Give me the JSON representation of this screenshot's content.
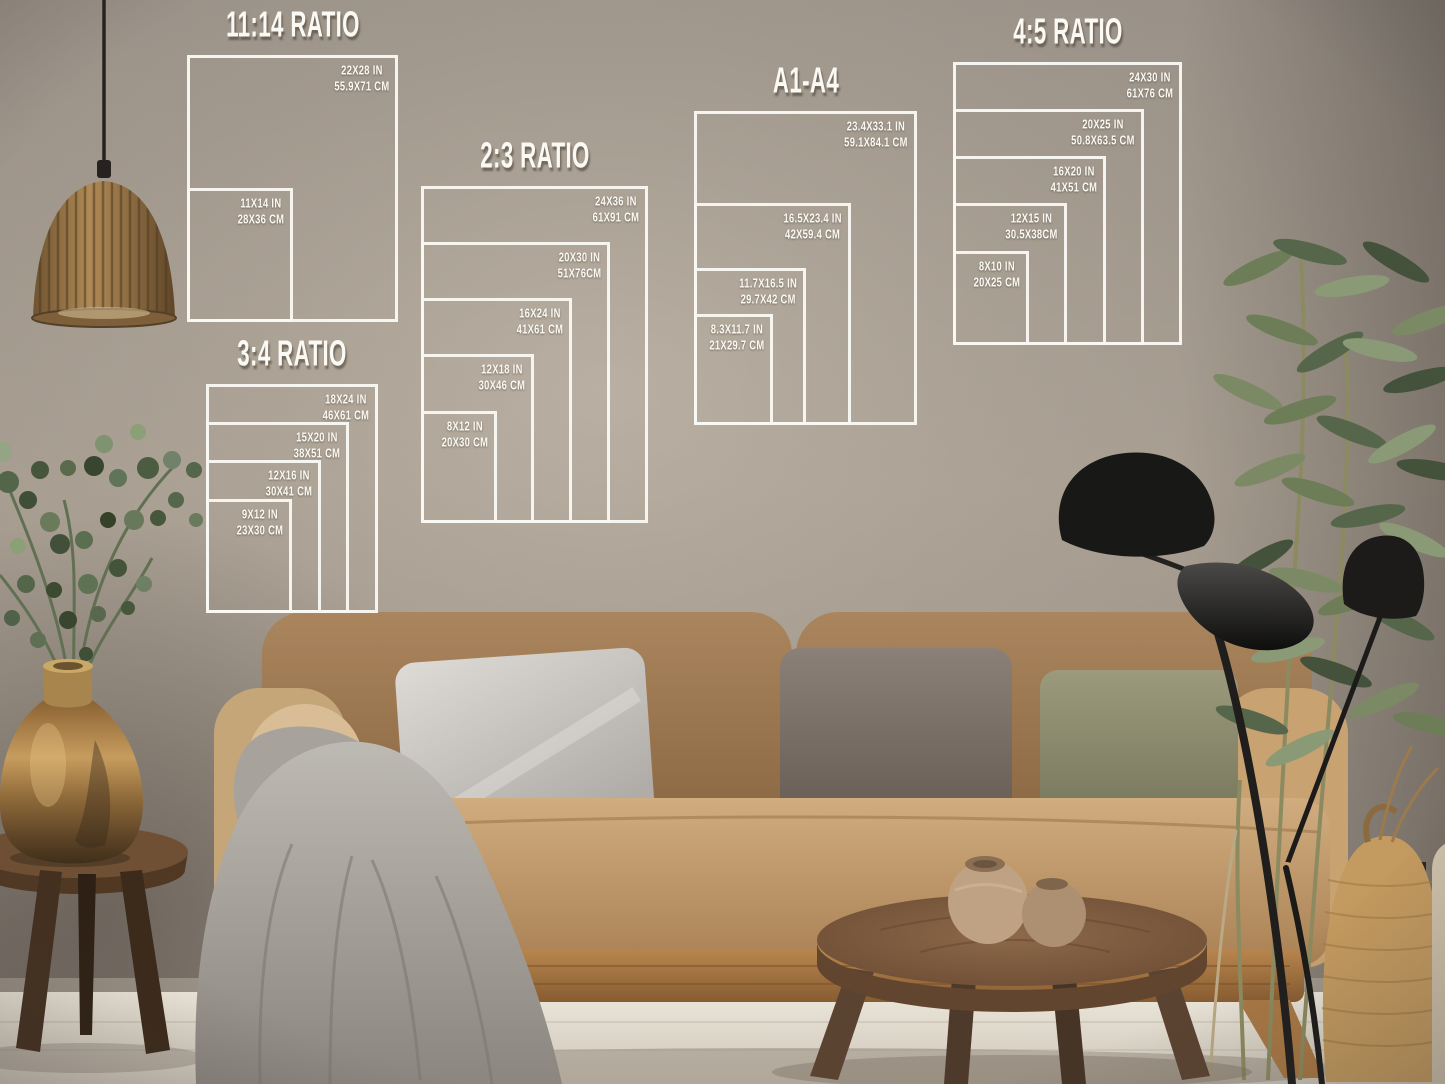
{
  "diagrams": [
    {
      "title": "11:14 RATIO",
      "sizes": [
        {
          "inches": "22X28 IN",
          "cm": "55.9X71 CM"
        },
        {
          "inches": "11X14 IN",
          "cm": "28X36 CM"
        }
      ]
    },
    {
      "title": "2:3 RATIO",
      "sizes": [
        {
          "inches": "24X36 IN",
          "cm": "61X91 CM"
        },
        {
          "inches": "20X30 IN",
          "cm": "51X76CM"
        },
        {
          "inches": "16X24 IN",
          "cm": "41X61 CM"
        },
        {
          "inches": "12X18 IN",
          "cm": "30X46 CM"
        },
        {
          "inches": "8X12 IN",
          "cm": "20X30 CM"
        }
      ]
    },
    {
      "title": "3:4 RATIO",
      "sizes": [
        {
          "inches": "18X24 IN",
          "cm": "46X61 CM"
        },
        {
          "inches": "15X20 IN",
          "cm": "38X51 CM"
        },
        {
          "inches": "12X16 IN",
          "cm": "30X41 CM"
        },
        {
          "inches": "9X12 IN",
          "cm": "23X30 CM"
        }
      ]
    },
    {
      "title": "A1-A4",
      "sizes": [
        {
          "inches": "23.4X33.1 IN",
          "cm": "59.1X84.1 CM"
        },
        {
          "inches": "16.5X23.4 IN",
          "cm": "42X59.4 CM"
        },
        {
          "inches": "11.7X16.5 IN",
          "cm": "29.7X42 CM"
        },
        {
          "inches": "8.3X11.7 IN",
          "cm": "21X29.7 CM"
        }
      ]
    },
    {
      "title": "4:5 RATIO",
      "sizes": [
        {
          "inches": "24X30 IN",
          "cm": "61X76 CM"
        },
        {
          "inches": "20X25 IN",
          "cm": "50.8X63.5 CM"
        },
        {
          "inches": "16X20 IN",
          "cm": "41X51 CM"
        },
        {
          "inches": "12X15 IN",
          "cm": "30.5X38CM"
        },
        {
          "inches": "8X10 IN",
          "cm": "20X25 CM"
        }
      ]
    }
  ],
  "style": {
    "overlay_line_color": "#faf8f3",
    "wall_color": "#9d948b",
    "sofa_color": "#b3895c",
    "floor_color": "#e0d9cd",
    "wood_color": "#7c5a40"
  },
  "scene_objects": [
    "pendant-lamp",
    "eucalyptus-plant",
    "brass-vase",
    "side-table",
    "sofa",
    "silver-pillow",
    "gray-pillow",
    "olive-pillow",
    "knit-blanket",
    "coffee-table",
    "ceramic-pots",
    "floor-lamp",
    "tall-plant",
    "woven-vase"
  ]
}
